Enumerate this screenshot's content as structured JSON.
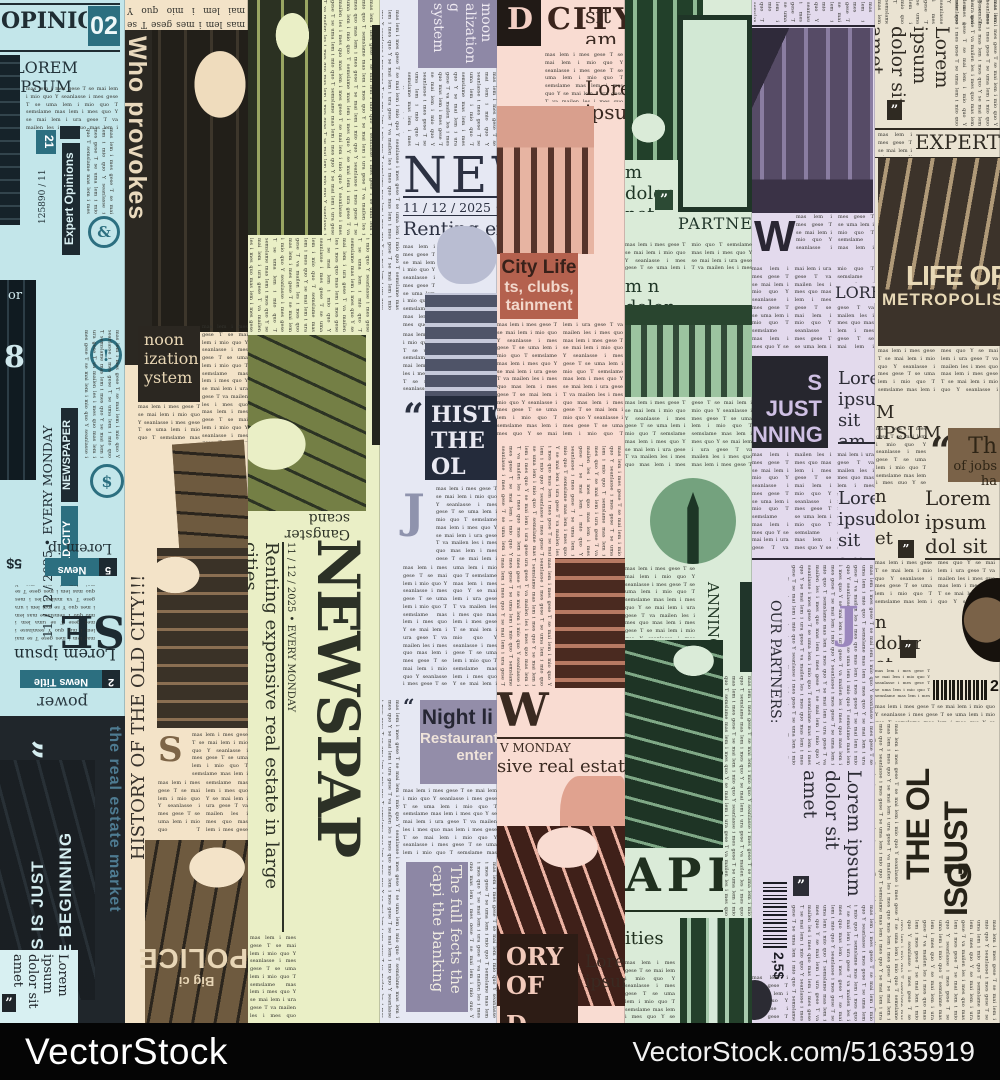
{
  "filler": "mas lem i mes gese T se mai lem i mio quo Y seanlasse i mes gese T se uma lem i mio quo T semslame mas lem i mes quo Y se mai lem i ura gese T va mailen les i mes quo",
  "watermark": {
    "brand": "VectorStock",
    "url": "VectorStock.com/51635919"
  },
  "s1": {
    "masthead": "OPINIONS",
    "page": "02",
    "subhead": "LOREM IPSUM",
    "issue": "125890 / 11",
    "issue_badge": "21",
    "expert": "Expert Opinions",
    "amp": "&",
    "excl": "!",
    "dollar": "$",
    "date": "11 / 12 / 2025 • EVERY MONDAY",
    "badge_newspaper": "NEWSPAPER",
    "badge_oldcity": "OLD CITY",
    "big8": "8",
    "frag_or": "or",
    "frag_se": "SE",
    "price": "5$",
    "news5_num": "5",
    "news5": "News",
    "lorem_ip": "Lorem ip",
    "lorem_ipsun": "Lorem ipsun",
    "news2_num": "2",
    "news2": "News Title",
    "power": "ations to power",
    "quote_open": "“",
    "quote_close": "”",
    "begin1": "THIS IS JUST",
    "begin2": "THE BEGINNING",
    "estate": "the real estate market",
    "card": "Lorem ipsum dolor sit amet"
  },
  "s2": {
    "headline": "Who provokes",
    "noon1": "noon",
    "noon2": "ization",
    "noon3": "ystem",
    "history": "HISTORY OF THE OLD CITY!!!",
    "dropcap": "S",
    "police": "POLICE",
    "bigci": "Big ci"
  },
  "s3": {
    "gangster": "Gangster scand",
    "date": "11 / 12 / 2025 • EVERY MONDAY",
    "headline": "Renting expensive real estate in large cities",
    "masthead": "NEWSPAP"
  },
  "s4": {
    "moon": "moon alization g system",
    "masthead": "NEWS",
    "date": "11 / 12 / 2025 • EVERY",
    "headline": "Renting expens",
    "quote": "“",
    "hist1": "HISTO",
    "hist2": "THE OL",
    "dropcap": "J",
    "night1": "Night li",
    "night2": "Restaurants",
    "night3": "enter",
    "banking": "The full fects the capi the banking"
  },
  "s5": {
    "city_d": "D",
    "city_rest": "CITY",
    "sit_frag": "sit am",
    "lorem_frag": "Lorem ipsum",
    "cl1": "City Life",
    "cl2": "ts, clubs,",
    "cl3": "tainment",
    "masthead": "W SPA",
    "monday": "V MONDAY",
    "estate": "sive real estate in c",
    "story1": "ORY OF",
    "story2": "D CITY",
    "lorem_bottom": "Lorem ipsum"
  },
  "s6": {
    "lorem_q": "m dolor net",
    "quote": "”",
    "partners": "PARTNERS",
    "lorem_frag": "m n dolor",
    "planning": "ANNING SYSTE",
    "masthead": "APE",
    "ities": "ities"
  },
  "s7": {
    "w": "W",
    "lorem_caps": "LOREM",
    "just1": "S JUST",
    "just2": "NNING",
    "card1": "Lorem ipsum sit am",
    "card2": "Lorem ipsum sit am",
    "partners": "OUR PARTNERS:",
    "rot_card": "Lorem ipsum dolor sit amet",
    "price": "2,5$",
    "quote": "”",
    "j": "J"
  },
  "s8": {
    "rot_top": "Lorem ipsum dolor sit amet",
    "quote": "”",
    "expert": "EXPERT O",
    "life1": "LIFE OF",
    "life2": "METROPOLIS",
    "m_ipsum": "M IPSUM",
    "quote_open": "“",
    "jobs1": "Th",
    "jobs2": "of jobs ha",
    "frag1": "n dolor et",
    "lorem_big": "Lorem ipsum dol sit amet",
    "frag2": "n dolor et",
    "barcode_price": "2,",
    "the_ol": "THE OL",
    "is_just": "IS JUST",
    "g": "G"
  }
}
